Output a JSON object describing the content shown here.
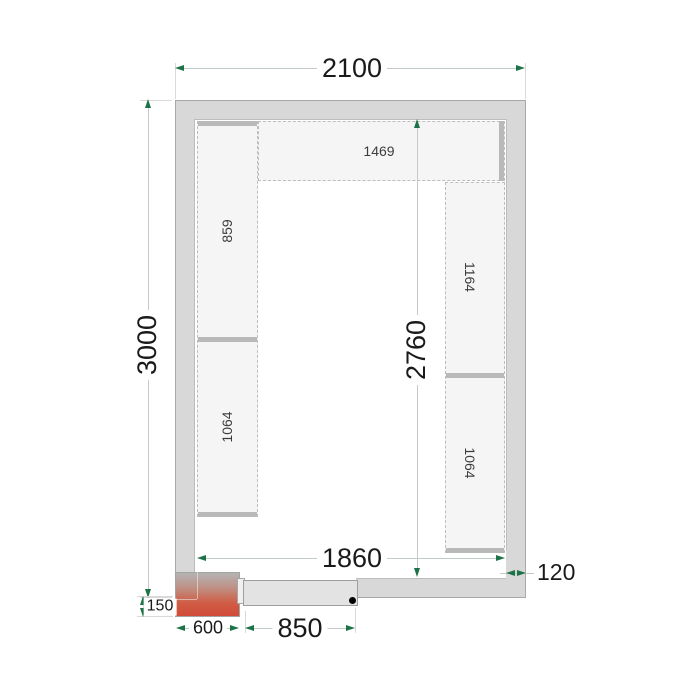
{
  "diagram": {
    "type": "cold-room-floor-plan",
    "dims": {
      "outer_width": "2100",
      "outer_height": "3000",
      "inner_height": "2760",
      "inner_width": "1860",
      "wall_thickness": "120",
      "door_width": "850",
      "unit_width": "600",
      "unit_offset": "150"
    },
    "shelves": {
      "top": "1469",
      "left_upper": "859",
      "left_lower": "1064",
      "right_upper": "1164",
      "right_lower": "1064"
    },
    "colors": {
      "wall_fill": "#d8d8d8",
      "shelf_fill": "#f5f5f5",
      "shelf_bar": "#b9b9b9",
      "dimension_arrow_green": "#1d7347",
      "cooling_unit_red": "#d14b38",
      "door_fill": "#e3e3e3",
      "handle_black": "#000000"
    }
  }
}
